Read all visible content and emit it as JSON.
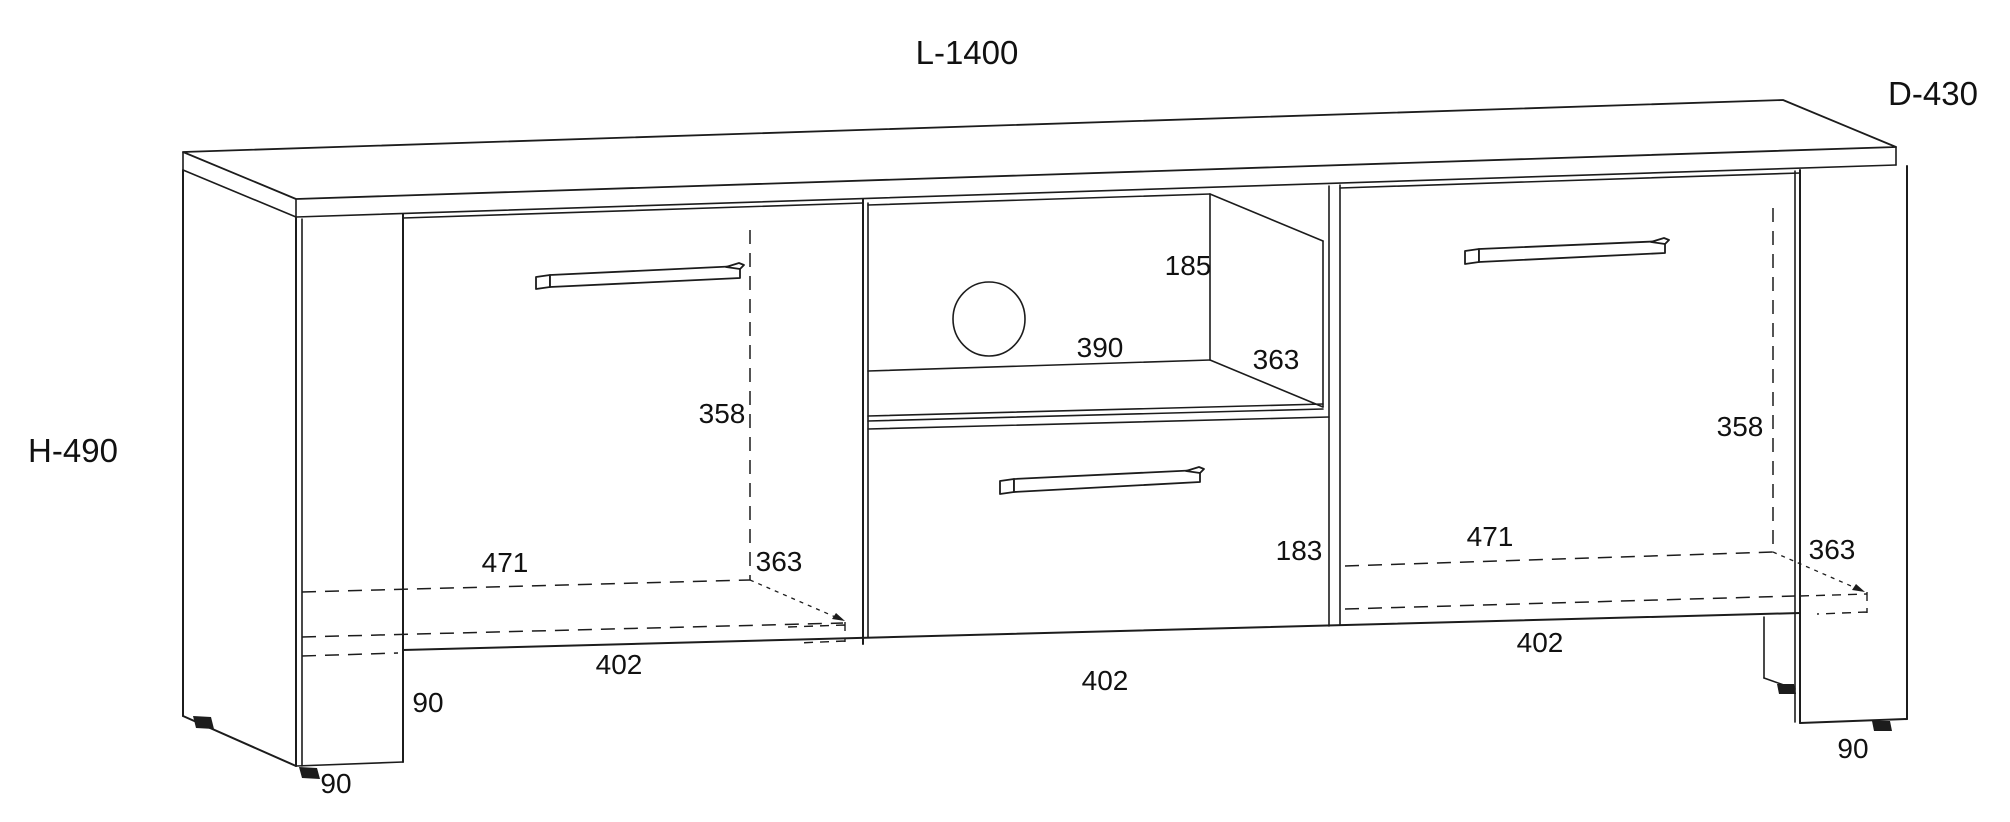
{
  "drawing_title": "TV cabinet technical drawing",
  "colors": {
    "line": "#1c1c1c",
    "text": "#111111",
    "background": "#ffffff"
  },
  "shapes": {
    "cable_hole_icon": "circle",
    "feet_icon": "small-trapezoid",
    "handle_icon": "bar-handle"
  },
  "dims": {
    "overall_length": "L-1400",
    "overall_depth": "D-430",
    "overall_height": "H-490",
    "niche_height": "185",
    "niche_width": "390",
    "niche_depth": "363",
    "left_inner_height": "358",
    "right_inner_height": "358",
    "left_inner_width": "471",
    "right_inner_width": "471",
    "left_inner_depth": "363",
    "right_inner_depth": "363",
    "left_door_width": "402",
    "drawer_width": "402",
    "right_door_width": "402",
    "drawer_front_height": "183",
    "plinth_gap_height": "90",
    "left_leg_depth": "90",
    "right_leg_depth": "90"
  }
}
